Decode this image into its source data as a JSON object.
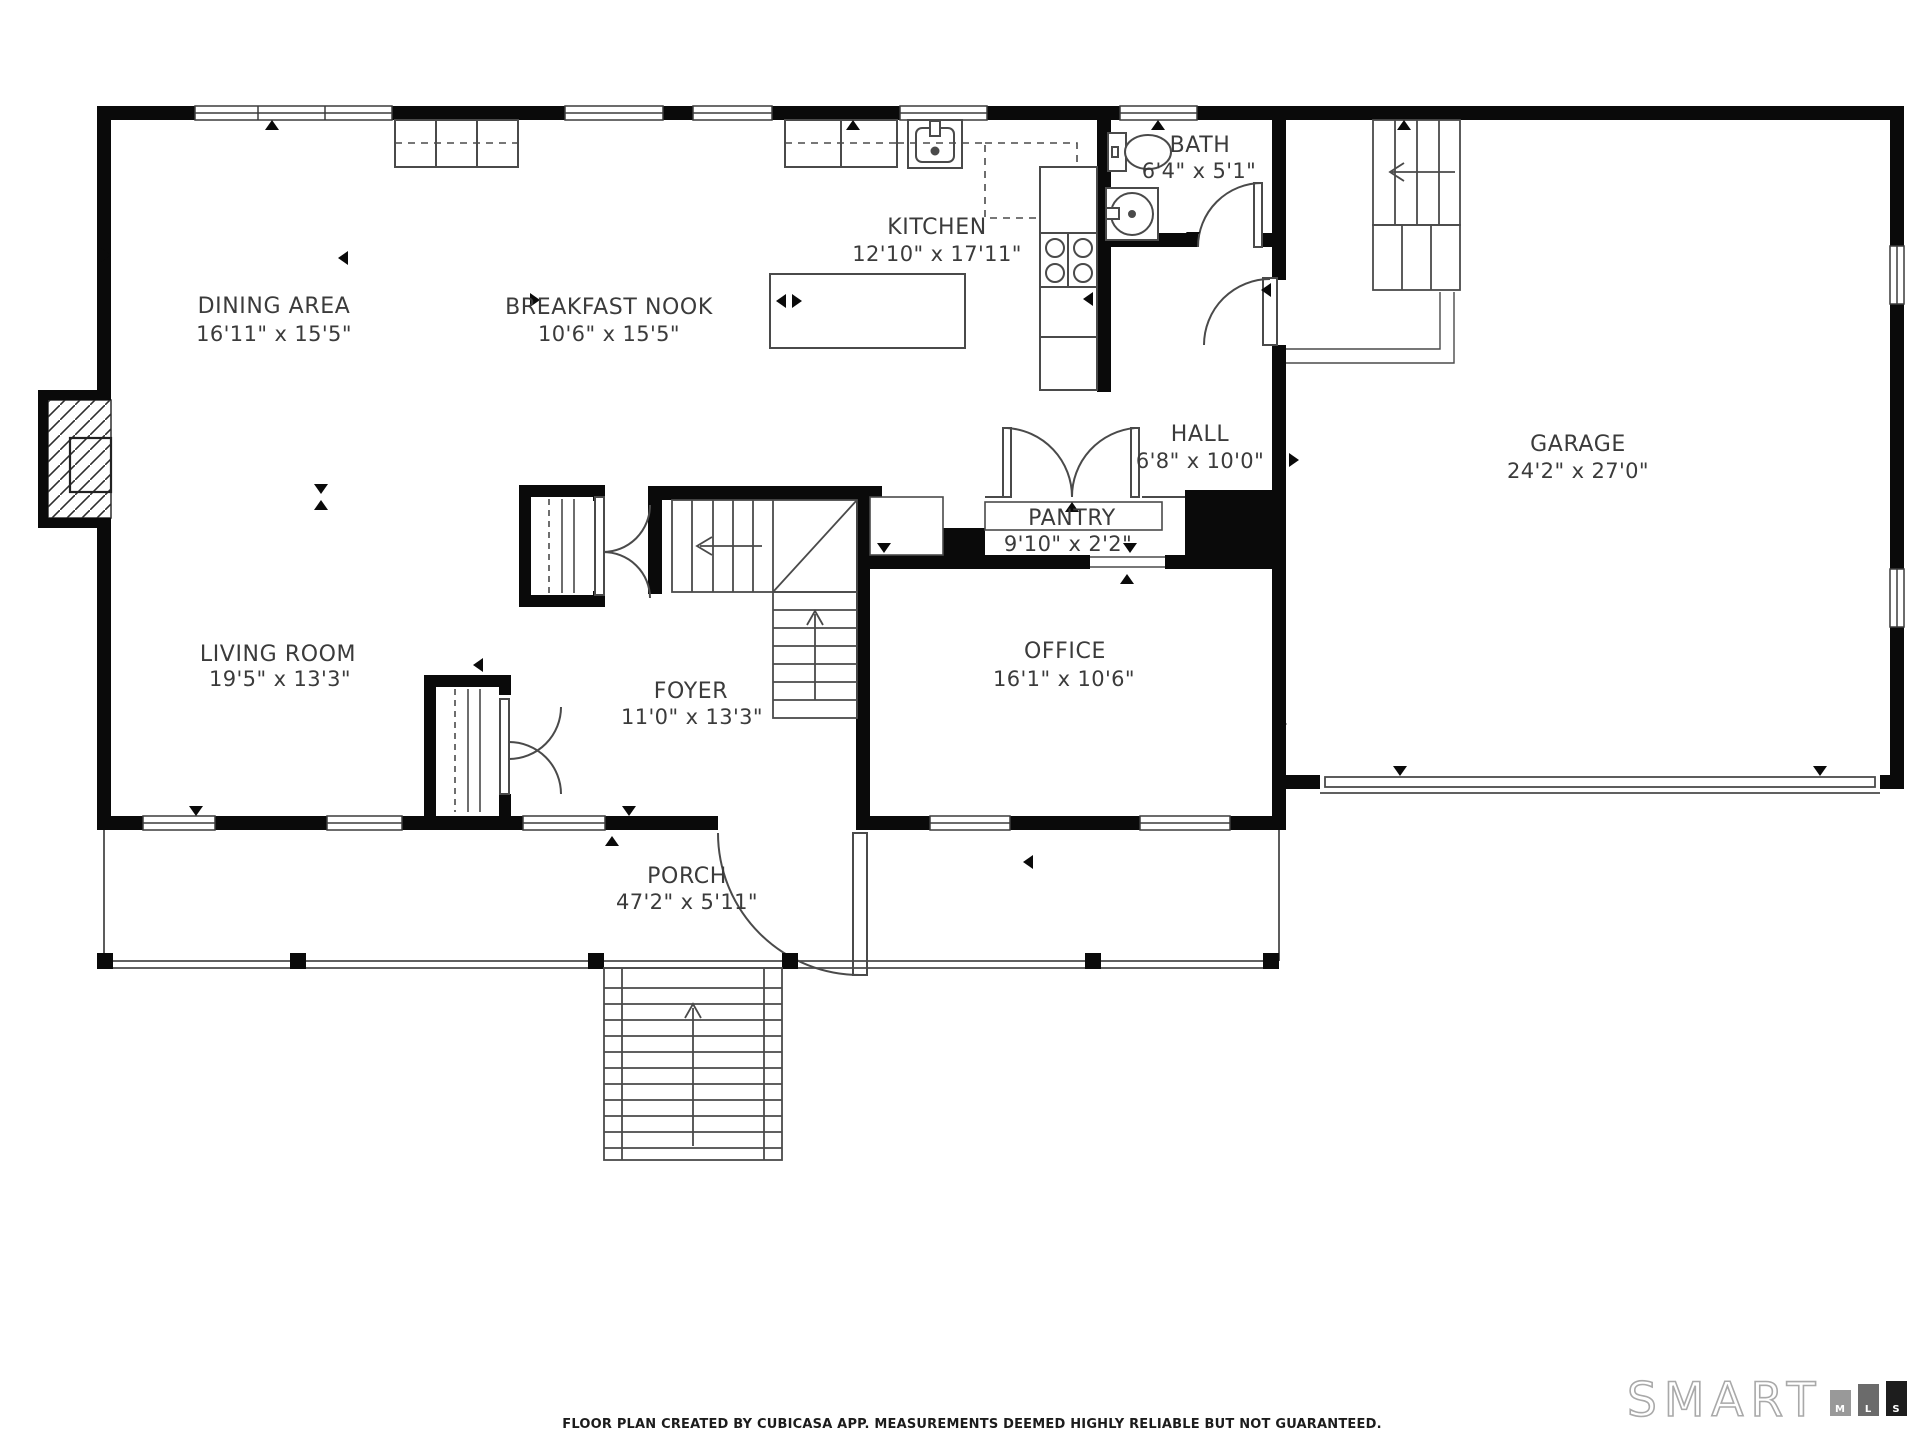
{
  "rooms": [
    {
      "name": "DINING AREA",
      "dims": "16'11\" x 15'5\""
    },
    {
      "name": "BREAKFAST NOOK",
      "dims": "10'6\" x 15'5\""
    },
    {
      "name": "KITCHEN",
      "dims": "12'10\" x 17'11\""
    },
    {
      "name": "BATH",
      "dims": "6'4\" x 5'1\""
    },
    {
      "name": "HALL",
      "dims": "6'8\" x 10'0\""
    },
    {
      "name": "PANTRY",
      "dims": "9'10\" x 2'2\""
    },
    {
      "name": "GARAGE",
      "dims": "24'2\" x 27'0\""
    },
    {
      "name": "LIVING ROOM",
      "dims": "19'5\" x 13'3\""
    },
    {
      "name": "FOYER",
      "dims": "11'0\" x 13'3\""
    },
    {
      "name": "OFFICE",
      "dims": "16'1\" x 10'6\""
    },
    {
      "name": "PORCH",
      "dims": "47'2\" x 5'11\""
    }
  ],
  "footer": {
    "disclaimer": "FLOOR PLAN CREATED BY CUBICASA APP. MEASUREMENTS DEEMED HIGHLY RELIABLE BUT NOT GUARANTEED."
  },
  "logo": {
    "brand": "SMART",
    "letters": [
      "M",
      "L",
      "S"
    ]
  },
  "colors": {
    "wall": "#0a0a0a",
    "thin_line": "#4a4a4a",
    "label": "#3b3b3b",
    "bar_m": "#999999",
    "bar_l": "#6b6b6b",
    "bar_s": "#1d1d1d"
  }
}
